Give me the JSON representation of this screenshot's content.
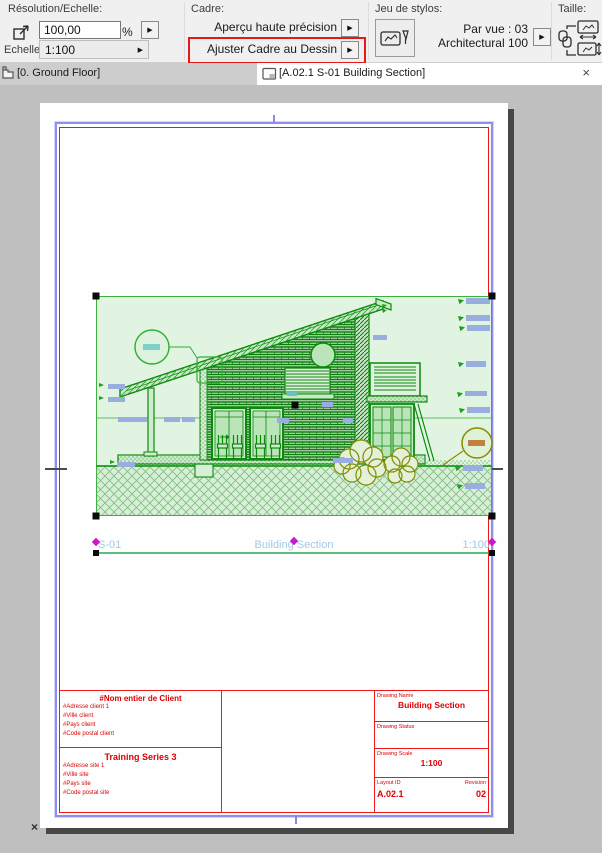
{
  "toolbar": {
    "resolution": {
      "label": "Résolution/Echelle:",
      "value": "100,00",
      "unit": "%",
      "scale_label": "Echelle:",
      "scale_value": "1:100"
    },
    "cadre": {
      "label": "Cadre:",
      "buttons": [
        "Aperçu haute précision",
        "Ajuster Cadre au Dessin"
      ]
    },
    "pens": {
      "label": "Jeu de stylos:",
      "line1": "Par vue : 03",
      "line2": "Architectural 100"
    },
    "size": {
      "label": "Taille:"
    }
  },
  "tabs": {
    "background": "[0. Ground Floor]",
    "active": "[A.02.1 S-01 Building Section]"
  },
  "drawing": {
    "id": "S-01",
    "name": "Building Section",
    "scale": "1:100"
  },
  "titleblock": {
    "client": {
      "title": "#Nom entier de Client",
      "lines": [
        "#Adresse client 1",
        "#Ville client",
        "#Pays client",
        "#Code postal client"
      ]
    },
    "site": {
      "title": "Training Series 3",
      "lines": [
        "#Adresse site 1",
        "#Ville site",
        "#Pays site",
        "#Code postal site"
      ]
    },
    "drawing_name_label": "Drawing Name",
    "drawing_name": "Building Section",
    "drawing_status_label": "Drawing Status",
    "drawing_scale_label": "Drawing Scale",
    "drawing_scale": "1:100",
    "layout_id_label": "Layout ID",
    "layout_id": "A.02.1",
    "revision_label": "Revision",
    "revision": "02"
  },
  "icons": {
    "dropdown_arrow": "▶",
    "close": "×",
    "origin": "×"
  },
  "colors": {
    "highlight_red": "#e81818",
    "drawing_green": "#0c8a0c",
    "label_blue": "#97aede",
    "drawing_title_blue": "#9fcae8",
    "handle_magenta": "#c818c8",
    "titleblock_red": "#dd0000",
    "selection_handle": "#000000",
    "paper_margin_blue": "#8f8ff0"
  }
}
